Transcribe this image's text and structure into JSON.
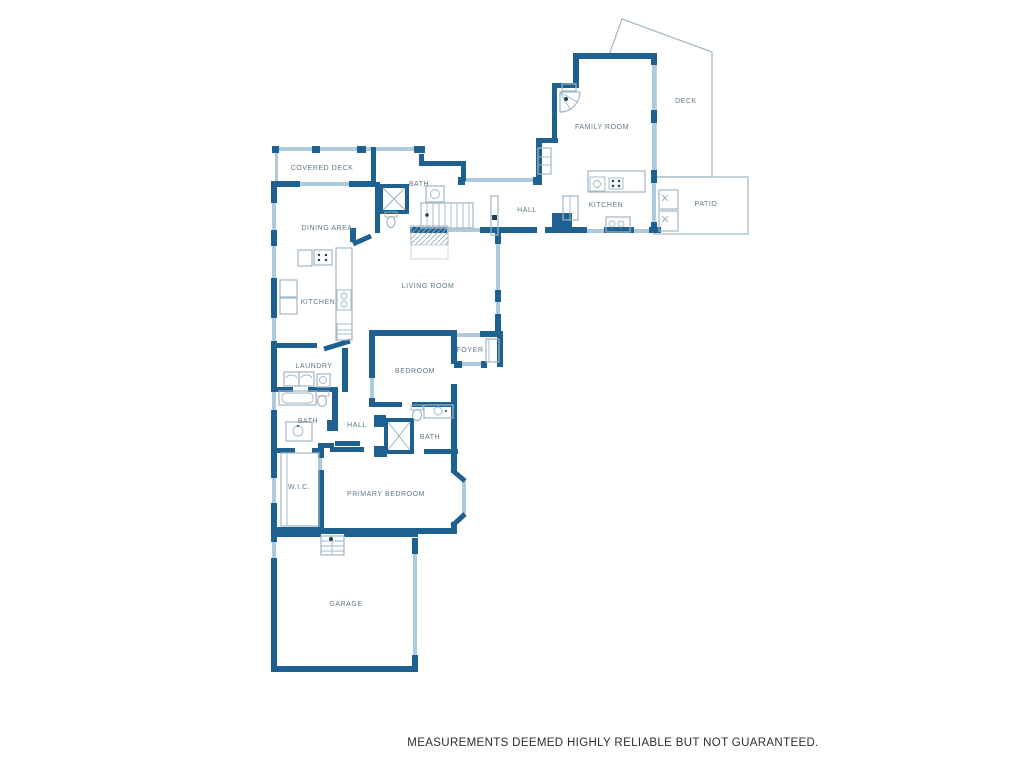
{
  "colors": {
    "wall": "#1e6191",
    "window": "#aecbdd",
    "fixture": "#9fb6c6",
    "hatch": "#9ab0bf",
    "label": "#5f7887",
    "disclaimer": "#2e2e2e"
  },
  "floor_plan": {
    "type": "residential-floor-plan",
    "disclaimer": "MEASUREMENTS DEEMED HIGHLY RELIABLE BUT NOT GUARANTEED.",
    "rooms": [
      {
        "id": "family-room",
        "label": "FAMILY ROOM",
        "x": 602,
        "y": 129
      },
      {
        "id": "deck",
        "label": "DECK",
        "x": 686,
        "y": 103
      },
      {
        "id": "kitchen-upper",
        "label": "KITCHEN",
        "x": 606,
        "y": 207
      },
      {
        "id": "patio",
        "label": "PATIO",
        "x": 706,
        "y": 206
      },
      {
        "id": "hall-upper",
        "label": "HALL",
        "x": 527,
        "y": 212
      },
      {
        "id": "covered-deck",
        "label": "COVERED DECK",
        "x": 322,
        "y": 170
      },
      {
        "id": "bath-upper",
        "label": "BATH",
        "x": 419,
        "y": 186
      },
      {
        "id": "dining-area",
        "label": "DINING AREA",
        "x": 327,
        "y": 230
      },
      {
        "id": "living-room",
        "label": "LIVING ROOM",
        "x": 428,
        "y": 288
      },
      {
        "id": "kitchen-main",
        "label": "KITCHEN",
        "x": 318,
        "y": 304
      },
      {
        "id": "laundry",
        "label": "LAUNDRY",
        "x": 314,
        "y": 368
      },
      {
        "id": "bedroom",
        "label": "BEDROOM",
        "x": 415,
        "y": 373
      },
      {
        "id": "foyer",
        "label": "FOYER",
        "x": 470,
        "y": 352
      },
      {
        "id": "bath-main",
        "label": "BATH",
        "x": 308,
        "y": 423
      },
      {
        "id": "hall-main",
        "label": "HALL",
        "x": 357,
        "y": 427
      },
      {
        "id": "bath-bedroom",
        "label": "BATH",
        "x": 430,
        "y": 439
      },
      {
        "id": "wic",
        "label": "W.I.C.",
        "x": 299,
        "y": 489
      },
      {
        "id": "primary-bedroom",
        "label": "PRIMARY BEDROOM",
        "x": 386,
        "y": 496
      },
      {
        "id": "garage",
        "label": "GARAGE",
        "x": 346,
        "y": 606
      }
    ]
  }
}
